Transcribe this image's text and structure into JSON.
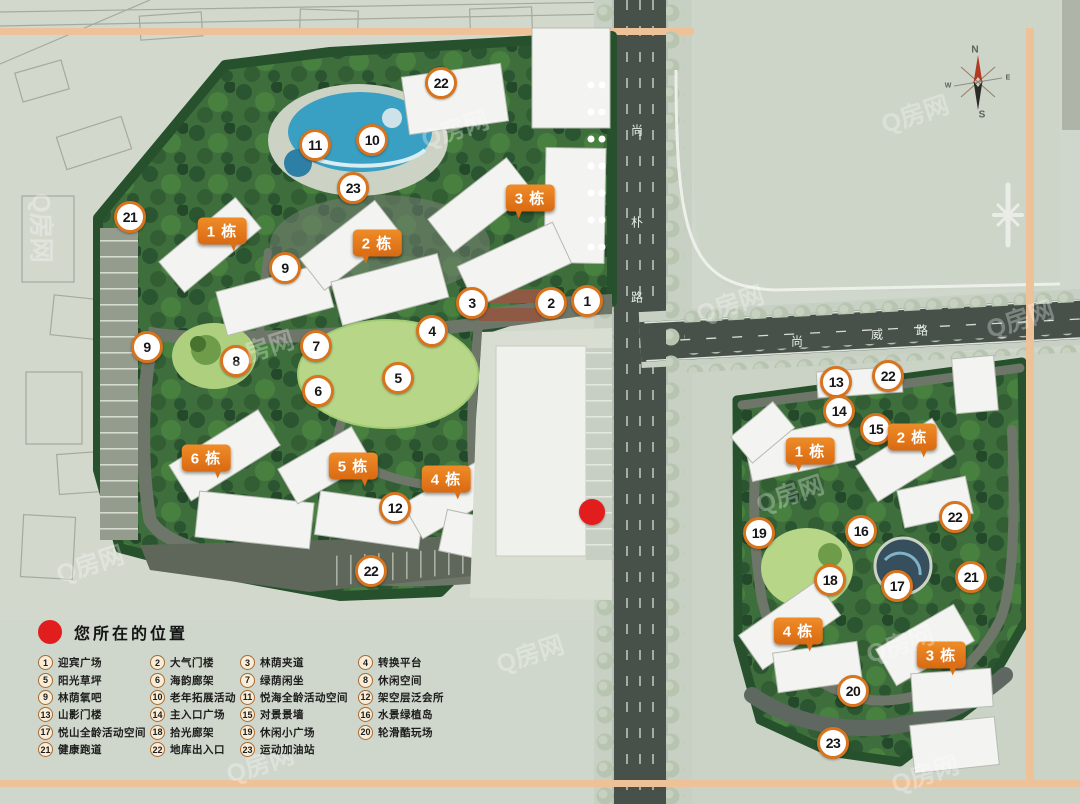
{
  "legend": {
    "title": "您所在的位置",
    "items": [
      {
        "num": "1",
        "label": "迎宾广场"
      },
      {
        "num": "2",
        "label": "大气门楼"
      },
      {
        "num": "3",
        "label": "林荫夹道"
      },
      {
        "num": "4",
        "label": "转换平台"
      },
      {
        "num": "5",
        "label": "阳光草坪"
      },
      {
        "num": "6",
        "label": "海韵廊架"
      },
      {
        "num": "7",
        "label": "绿荫闲坐"
      },
      {
        "num": "8",
        "label": "休闲空间"
      },
      {
        "num": "9",
        "label": "林荫氧吧"
      },
      {
        "num": "10",
        "label": "老年拓展活动"
      },
      {
        "num": "11",
        "label": "悦海全龄活动空间"
      },
      {
        "num": "12",
        "label": "架空层泛会所"
      },
      {
        "num": "13",
        "label": "山影门楼"
      },
      {
        "num": "14",
        "label": "主入口广场"
      },
      {
        "num": "15",
        "label": "对景景墙"
      },
      {
        "num": "16",
        "label": "水景绿植岛"
      },
      {
        "num": "17",
        "label": "悦山全龄活动空间"
      },
      {
        "num": "18",
        "label": "拾光廊架"
      },
      {
        "num": "19",
        "label": "休闲小广场"
      },
      {
        "num": "20",
        "label": "轮滑酷玩场"
      },
      {
        "num": "21",
        "label": "健康跑道"
      },
      {
        "num": "22",
        "label": "地库出入口"
      },
      {
        "num": "23",
        "label": "运动加油站"
      }
    ]
  },
  "roads": {
    "vertical_name": "尚朴路",
    "horizontal_name": "尚威路"
  },
  "compass": {
    "north": "N",
    "south": "S",
    "west": "W",
    "east": "E"
  },
  "watermark_text": "Q房网",
  "map": {
    "red_dot": {
      "x": 592,
      "y": 512
    },
    "building_labels": [
      {
        "text": "1 栋",
        "x": 222,
        "y": 231,
        "tail": "right"
      },
      {
        "text": "2 栋",
        "x": 377,
        "y": 243,
        "tail": "left"
      },
      {
        "text": "3 栋",
        "x": 530,
        "y": 198,
        "tail": "left"
      },
      {
        "text": "6 栋",
        "x": 206,
        "y": 458,
        "tail": "right"
      },
      {
        "text": "5 栋",
        "x": 353,
        "y": 466,
        "tail": "right"
      },
      {
        "text": "4 栋",
        "x": 446,
        "y": 479,
        "tail": "right"
      },
      {
        "text": "1 栋",
        "x": 810,
        "y": 451,
        "tail": "left"
      },
      {
        "text": "2 栋",
        "x": 912,
        "y": 437,
        "tail": "right"
      },
      {
        "text": "4 栋",
        "x": 798,
        "y": 631,
        "tail": "right"
      },
      {
        "text": "3 栋",
        "x": 941,
        "y": 655,
        "tail": "right"
      }
    ],
    "markers": [
      {
        "n": "21",
        "x": 130,
        "y": 217
      },
      {
        "n": "22",
        "x": 441,
        "y": 83
      },
      {
        "n": "11",
        "x": 315,
        "y": 145
      },
      {
        "n": "10",
        "x": 372,
        "y": 140
      },
      {
        "n": "23",
        "x": 353,
        "y": 188
      },
      {
        "n": "9",
        "x": 285,
        "y": 268
      },
      {
        "n": "3",
        "x": 472,
        "y": 303
      },
      {
        "n": "2",
        "x": 551,
        "y": 303
      },
      {
        "n": "1",
        "x": 587,
        "y": 301
      },
      {
        "n": "4",
        "x": 432,
        "y": 331
      },
      {
        "n": "7",
        "x": 316,
        "y": 346
      },
      {
        "n": "9",
        "x": 147,
        "y": 347
      },
      {
        "n": "8",
        "x": 236,
        "y": 361
      },
      {
        "n": "5",
        "x": 398,
        "y": 378
      },
      {
        "n": "6",
        "x": 318,
        "y": 391
      },
      {
        "n": "12",
        "x": 395,
        "y": 508
      },
      {
        "n": "22",
        "x": 371,
        "y": 571
      },
      {
        "n": "13",
        "x": 836,
        "y": 382
      },
      {
        "n": "22",
        "x": 888,
        "y": 376
      },
      {
        "n": "14",
        "x": 839,
        "y": 411
      },
      {
        "n": "15",
        "x": 876,
        "y": 429
      },
      {
        "n": "19",
        "x": 759,
        "y": 533
      },
      {
        "n": "16",
        "x": 861,
        "y": 531
      },
      {
        "n": "22",
        "x": 955,
        "y": 517
      },
      {
        "n": "18",
        "x": 830,
        "y": 580
      },
      {
        "n": "17",
        "x": 897,
        "y": 586
      },
      {
        "n": "21",
        "x": 971,
        "y": 577
      },
      {
        "n": "20",
        "x": 853,
        "y": 691
      },
      {
        "n": "23",
        "x": 833,
        "y": 743
      }
    ]
  },
  "colors": {
    "accent_orange": "#e2741c",
    "marker_ring": "#d8731e",
    "frame_orange": "#eec299",
    "red_dot": "#e11d1d",
    "site_green": "#3e6e3c",
    "road_dark": "#47514a"
  }
}
